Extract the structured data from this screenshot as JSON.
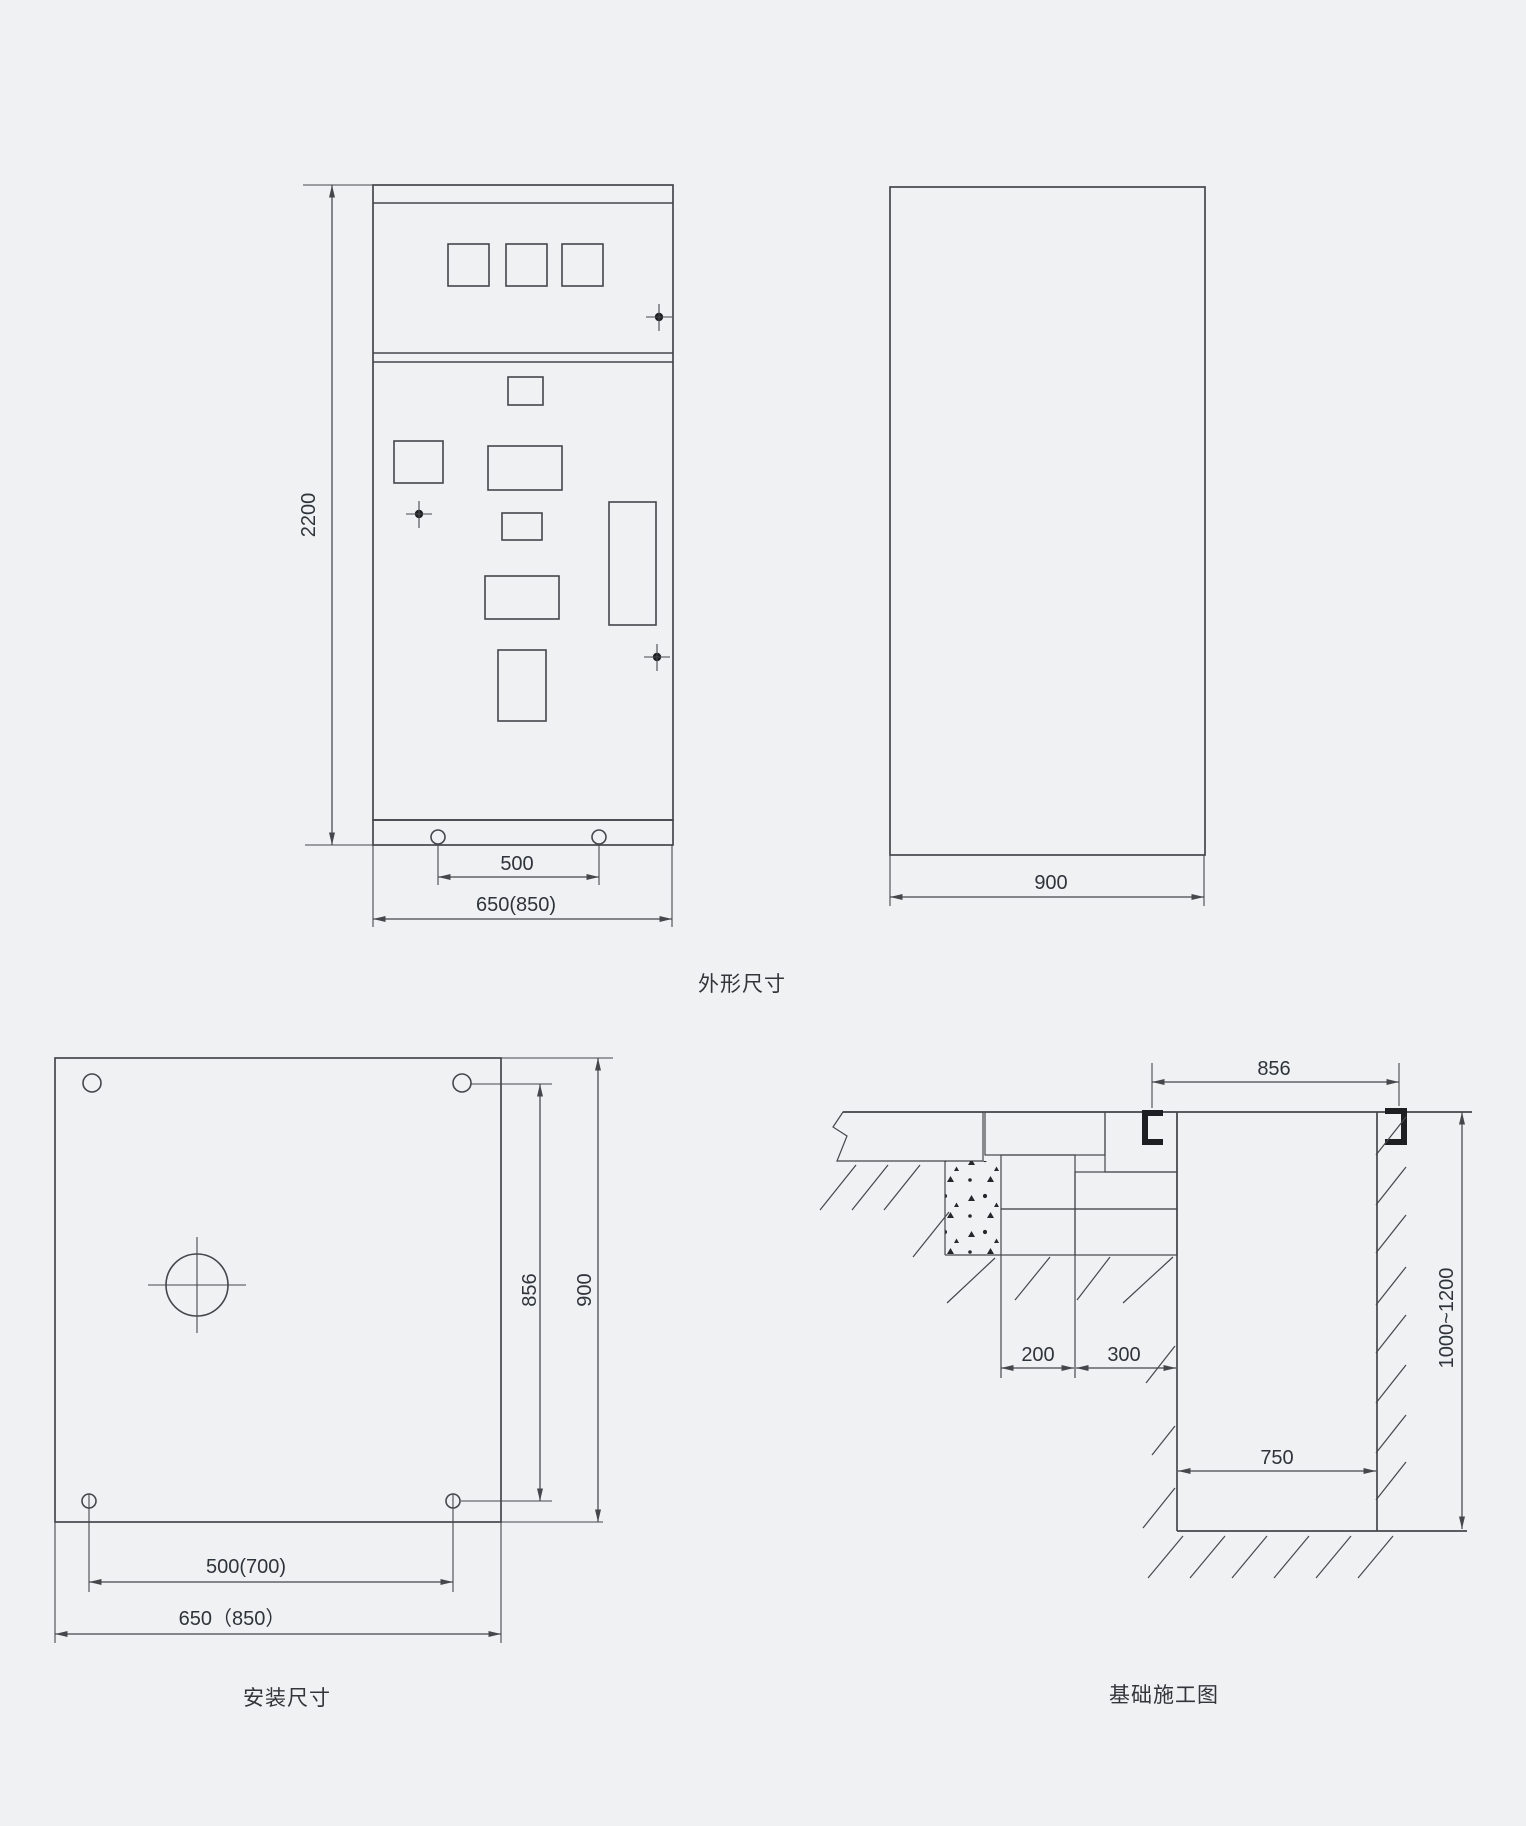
{
  "colors": {
    "background": "#f0f1f3",
    "line": "#45474c",
    "steel_channel": "#1e1f22",
    "text": "#2e343b"
  },
  "outline_view": {
    "caption": "外形尺寸",
    "front": {
      "height": "2200",
      "foot_hole_spacing": "500",
      "width": "650(850)"
    },
    "side": {
      "depth": "900"
    }
  },
  "installation_view": {
    "caption": "安装尺寸",
    "hole_span_vertical": "856",
    "depth": "900",
    "hole_spacing_horizontal": "500(700)",
    "width": "650（850）"
  },
  "foundation_view": {
    "caption": "基础施工图",
    "channel_spacing": "856",
    "strip_width": "200",
    "ledge_width": "300",
    "pit_width": "750",
    "pit_depth": "1000~1200"
  }
}
